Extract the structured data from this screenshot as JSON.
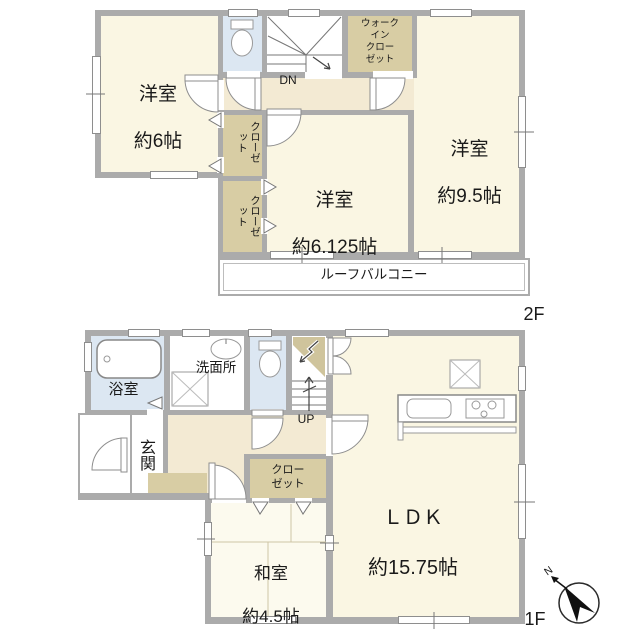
{
  "palette": {
    "wall": "#ABABAB",
    "room": "#FAF6E3",
    "washitsu": "#FCFAEE",
    "hall": "#F3EAD3",
    "tan": "#D8CDA4",
    "blue": "#DCE7F2",
    "line": "#808080",
    "text": "#1A1A1A"
  },
  "floor2": {
    "floor_label": "2F",
    "room_west": {
      "name": "洋室",
      "size": "約6帖"
    },
    "room_east": {
      "name": "洋室",
      "size": "約9.5帖"
    },
    "room_center": {
      "name": "洋室",
      "size": "約6.125帖"
    },
    "walk_in_closet": "ウォーク\nイン\nクロー\nゼット",
    "closet_a": "クローゼット",
    "closet_b": "クローゼット",
    "stairs_label": "DN",
    "balcony_label": "ルーフバルコニー"
  },
  "floor1": {
    "floor_label": "1F",
    "bath_label": "浴室",
    "washroom_label": "洗面所",
    "entrance_label": "玄関",
    "closet_label": "クロー\nゼット",
    "japanese_room": {
      "name": "和室",
      "size": "約4.5帖"
    },
    "ldk": {
      "name": "ＬＤＫ",
      "size": "約15.75帖"
    },
    "stairs_label": "UP",
    "compass_north": "N"
  }
}
